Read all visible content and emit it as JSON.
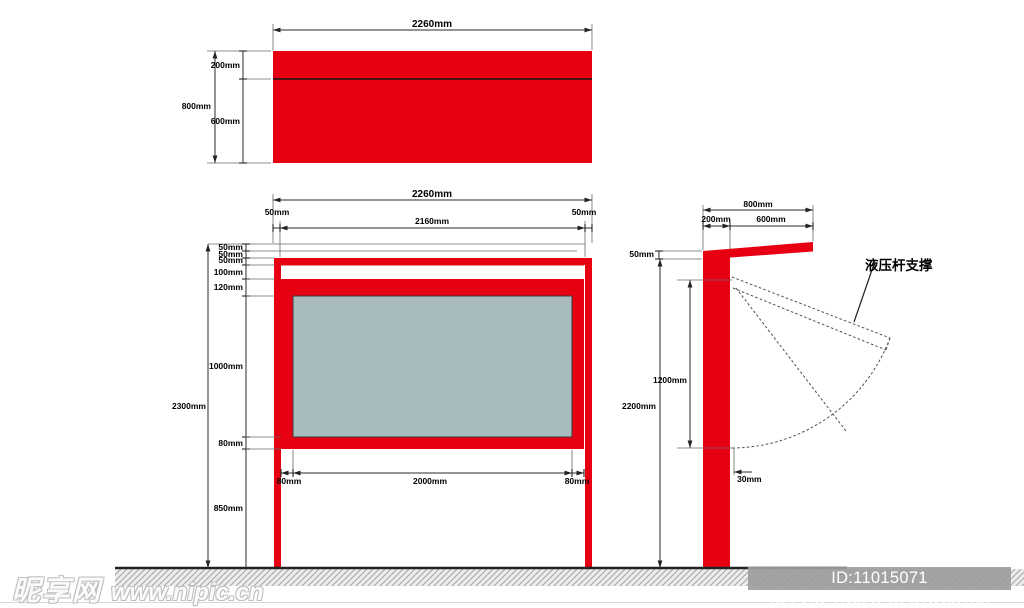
{
  "drawing": {
    "top_view": {
      "width": "2260mm",
      "total_height": "800mm",
      "top_height": "200mm",
      "bottom_height": "600mm"
    },
    "front_view": {
      "width": "2260mm",
      "left_post": "50mm",
      "inner_width": "2160mm",
      "right_post": "50mm",
      "total_height": "2300mm",
      "chain": [
        "50mm",
        "50mm",
        "50mm",
        "100mm",
        "120mm",
        "1000mm",
        "80mm",
        "850mm"
      ],
      "glass_left": "80mm",
      "glass_width": "2000mm",
      "glass_right": "80mm"
    },
    "side_view": {
      "total_depth": "800mm",
      "post_depth": "200mm",
      "canopy_depth": "600mm",
      "canopy_thickness": "50mm",
      "post_height": "2200mm",
      "door_height": "1200mm",
      "door_gap": "30mm",
      "annotation": "液压杆支撑"
    }
  },
  "watermark": {
    "site_name": "昵享网",
    "site_url": "www.nipic.cn"
  },
  "footer": {
    "id_text": "ID:11015071 NO:20251009210928206108"
  },
  "colors": {
    "frame_red": "#e60012",
    "glass_gray": "#a9bcbd"
  }
}
